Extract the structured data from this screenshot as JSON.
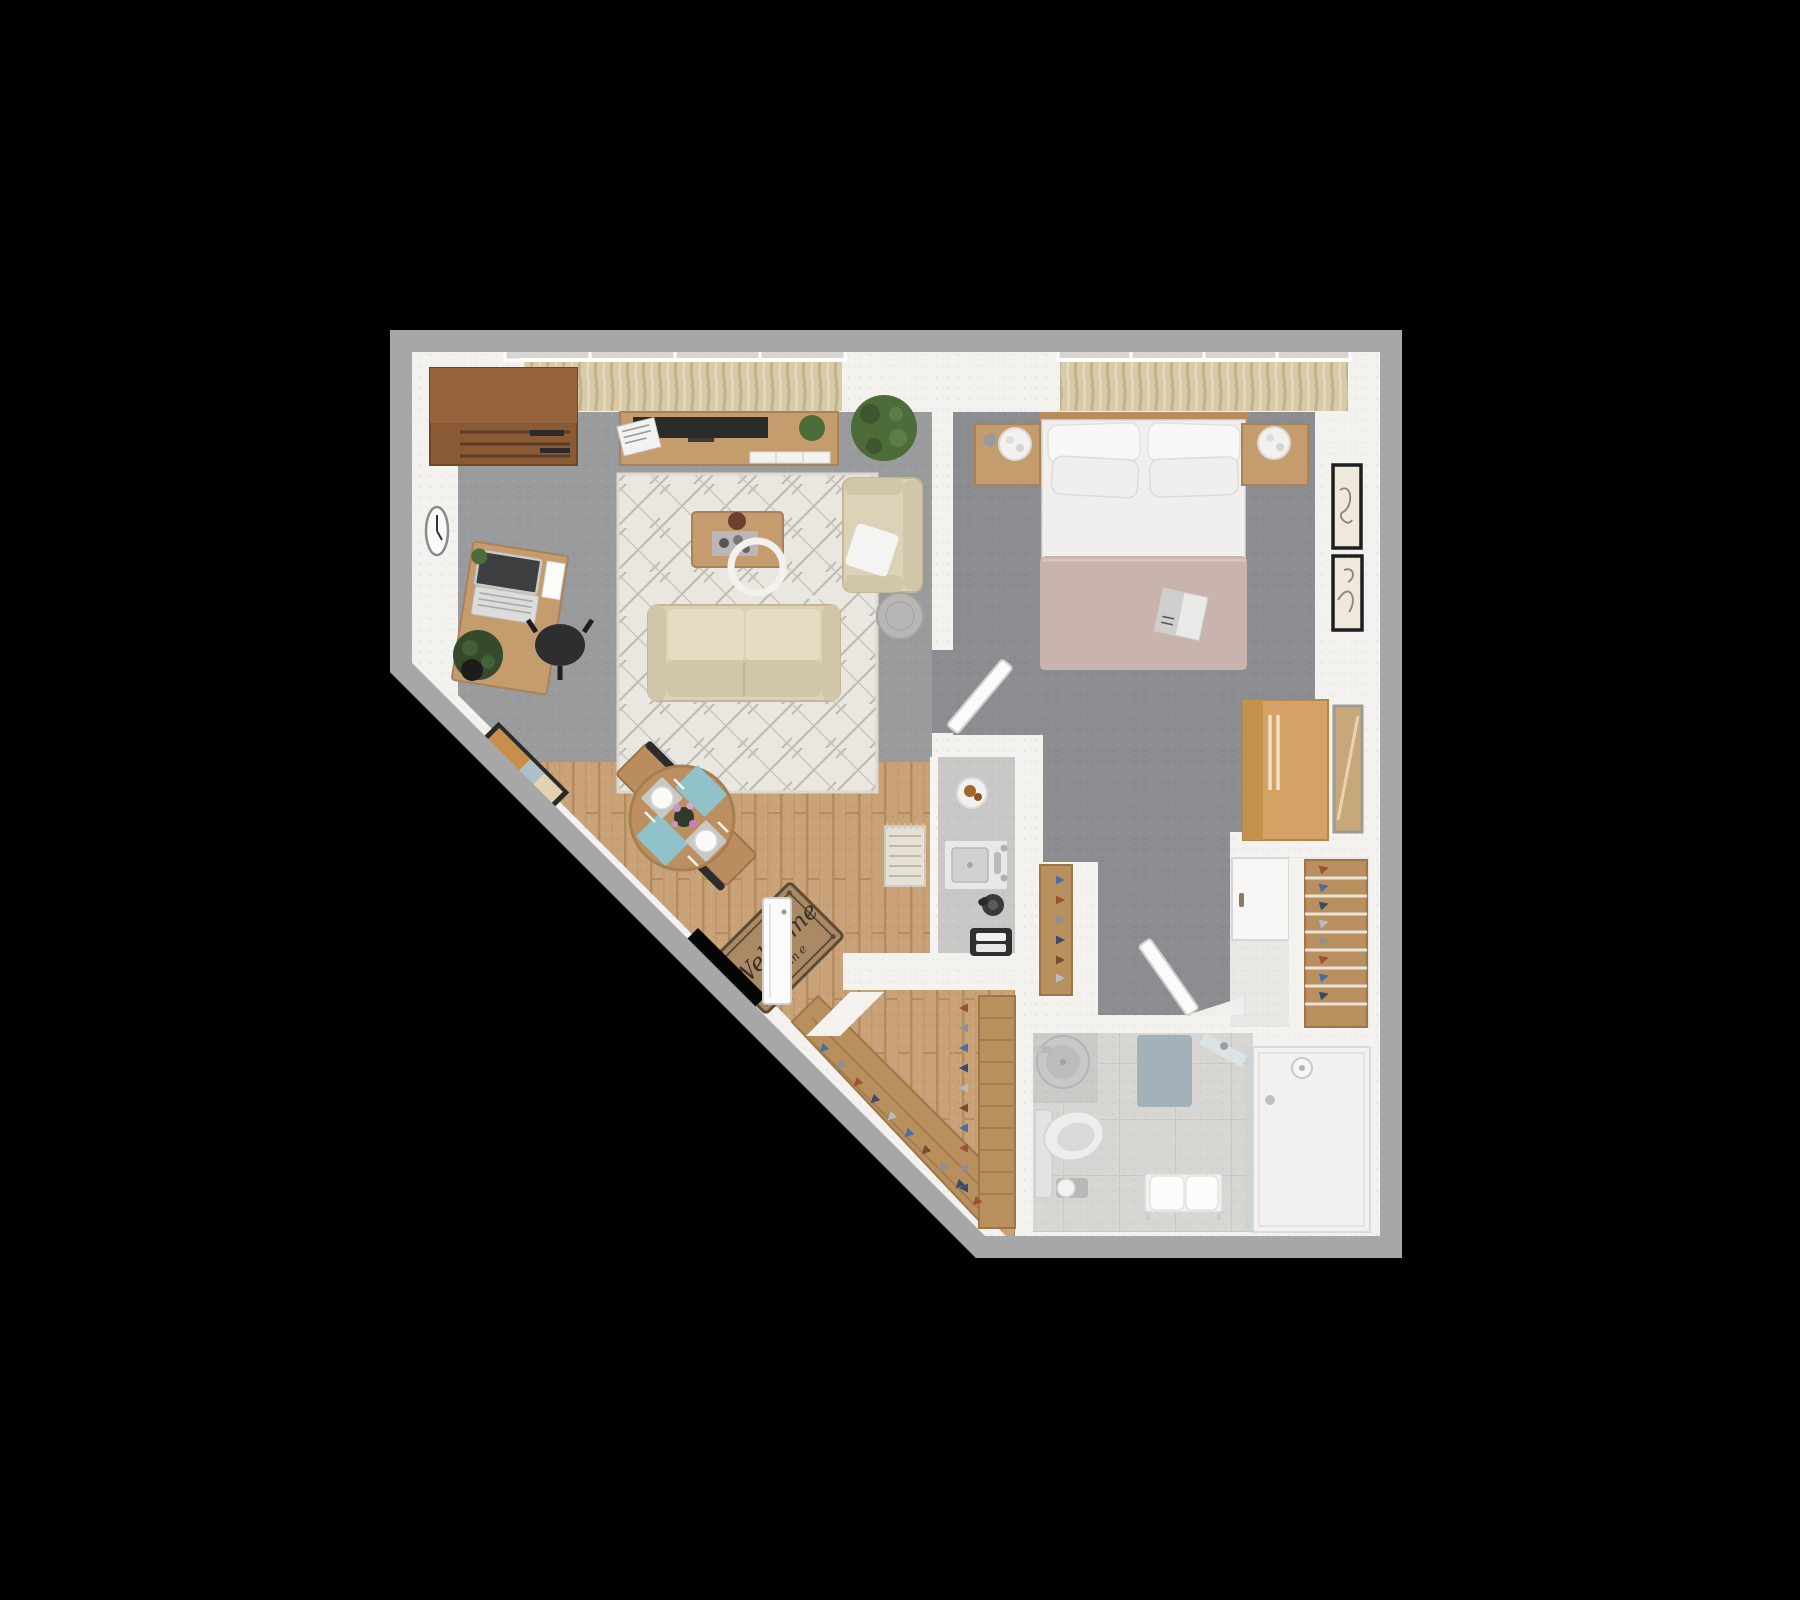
{
  "scene": {
    "type": "3d-floor-plan-top-down-render",
    "description": "One-bedroom apartment 3D floor plan with angled entry wall, on black background",
    "background": "#000000"
  },
  "entry": {
    "mat_text": "Welcome",
    "mat_subtext": "home"
  },
  "colors": {
    "bg": "#000000",
    "outer": "#a7a7a7",
    "wall": "#f3f2ee",
    "carpetLiving": "#9a9b9d",
    "carpetBed": "#8c8d90",
    "woodFloor": "#c9a377",
    "woodLine": "#b38b5e",
    "woodFurn": "#c59c6d",
    "woodDark": "#8a5a35",
    "woodWardrobe": "#d3a264",
    "shelfWood": "#b8905e",
    "tile": "#d7d6d3",
    "tileLine": "#c5c4c1",
    "rug": "#eae7e0",
    "rugLine": "#bcb9b1",
    "sofa": "#ddd2b8",
    "sofaDark": "#d2c6aa",
    "sofaLight": "#e6dcc4",
    "curtain": "#d8cba9",
    "curtainDark": "#c3b28a",
    "duvet": "#c9b3ad",
    "whiteSoft": "#f4f4f2",
    "glass": "#c9d3d8",
    "mat": "#a98a64",
    "matText": "#3a3028",
    "plant": "#4e6b3a",
    "plantDark": "#344a2a",
    "teal": "#8fc3c9",
    "counter": "#c9c8c6",
    "applianceDark": "#2f2f31"
  },
  "rooms": {
    "living_room": {
      "floor": "grey carpet",
      "furniture": [
        "corner-cabinet",
        "wall-clock",
        "desk",
        "laptop",
        "desk-plant",
        "office-chair",
        "tv-console",
        "tv",
        "magazine-stack",
        "console-plant",
        "floor-plant",
        "window-curtains",
        "area-rug",
        "coffee-table",
        "serving-tray",
        "decor-bowl",
        "arc-floor-lamp",
        "sofa",
        "armchair",
        "throw-pillow",
        "round-side-table"
      ]
    },
    "bedroom": {
      "floor": "grey carpet",
      "furniture": [
        "double-bed",
        "pillows-x4",
        "blush-duvet",
        "magazine",
        "headboard",
        "nightstand-left",
        "nightstand-right",
        "round-lamp-x2",
        "window-curtains",
        "wall-art-x2",
        "wardrobe",
        "leaning-mirror"
      ]
    },
    "kitchenette": {
      "floor": "grey counter niche",
      "furniture": [
        "counter",
        "plate-with-pastry",
        "sink",
        "faucet",
        "coffee-pot",
        "toaster",
        "runner-rug"
      ]
    },
    "entry_dining": {
      "floor": "wood planks",
      "furniture": [
        "entry-door",
        "welcome-mat",
        "round-dining-table",
        "dining-chair-x2",
        "placemats-teal-x2",
        "plates-x2",
        "flower-centerpiece",
        "wall-picture-diagonal"
      ]
    },
    "walk_in_closet": {
      "floor": "wood planks",
      "furniture": [
        "diagonal-shoe-shelf",
        "side-shoe-shelf",
        "shoes"
      ]
    },
    "dressing_nook": {
      "floor": "light",
      "furniture": [
        "white-cabinet",
        "shoe-rack",
        "shoes"
      ]
    },
    "bathroom": {
      "floor": "light tile",
      "furniture": [
        "round-sink",
        "toilet",
        "toilet-paper-stand",
        "bath-mat",
        "towel-bench",
        "glass-shower",
        "shower-head",
        "drain",
        "bathroom-door"
      ]
    }
  },
  "shoe_colors": [
    "#4a6da8",
    "#9c5233",
    "#8a8f98",
    "#3b4a6b",
    "#b7bcc2",
    "#7a4a2e"
  ]
}
